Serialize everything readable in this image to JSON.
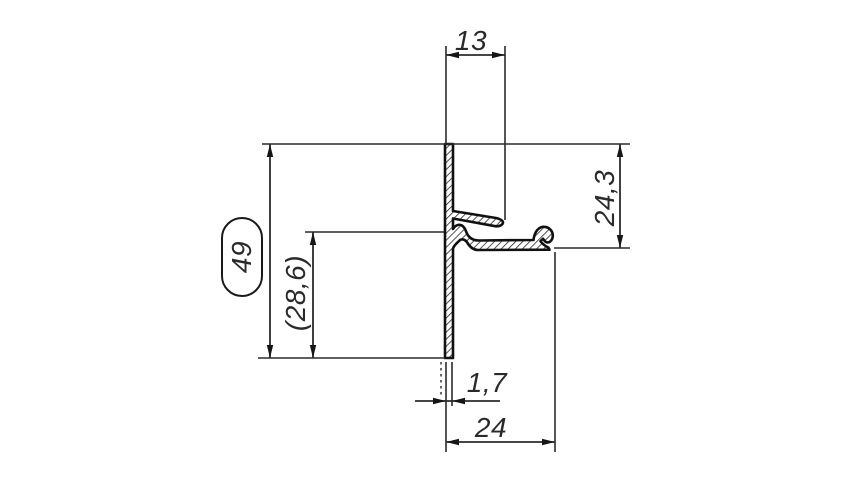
{
  "drawing": {
    "type": "technical-profile-cross-section",
    "background_color": "#ffffff",
    "line_color": "#2b2b2b",
    "profile_outline_color": "#111111",
    "text_color": "#2a2a2a",
    "dimensions": {
      "top_width": "13",
      "right_height": "24,3",
      "overall_height": "49",
      "partial_height": "(28,6)",
      "wall_thickness": "1,7",
      "bottom_width": "24"
    }
  }
}
